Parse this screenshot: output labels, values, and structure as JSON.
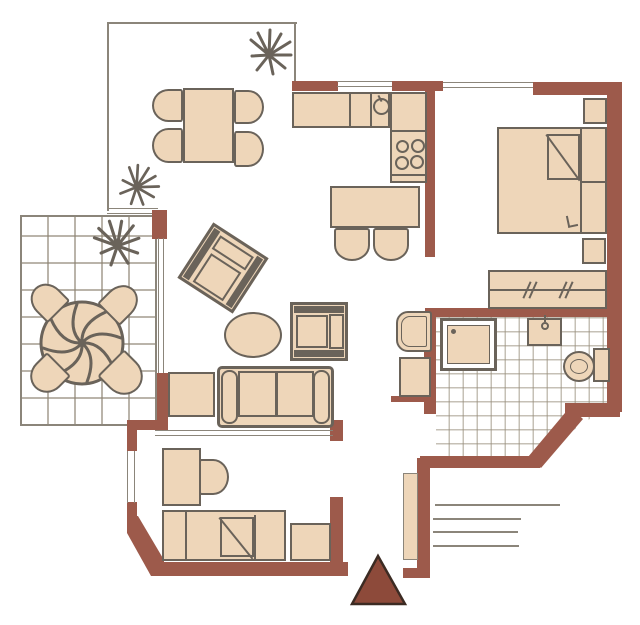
{
  "plan": {
    "type": "apartment-floor-plan",
    "title": "",
    "rooms": [
      {
        "name": "dining-terrace",
        "position": "top-left",
        "enclosure": "open (thin border)",
        "furniture": [
          "rectangular-dining-table",
          "chair x4",
          "plant x2"
        ]
      },
      {
        "name": "kitchen",
        "position": "top-middle",
        "furniture": [
          "l-shaped-counter",
          "sink",
          "stove-4-burners",
          "kitchen-table",
          "chair x2"
        ]
      },
      {
        "name": "bedroom-1",
        "position": "top-right",
        "furniture": [
          "double-bed",
          "nightstand x2",
          "wardrobe"
        ]
      },
      {
        "name": "living-room",
        "position": "center",
        "furniture": [
          "armchair-rotated",
          "armchair",
          "oval-coffee-table",
          "sofa-2-seat",
          "side-table"
        ]
      },
      {
        "name": "tiled-terrace",
        "position": "middle-left",
        "floor": "tiles",
        "furniture": [
          "round-table-with-parasol",
          "chair x4",
          "plant"
        ]
      },
      {
        "name": "bathroom",
        "position": "middle-right",
        "floor": "tiles",
        "furniture": [
          "shower",
          "washbasin",
          "toilet-with-cistern"
        ]
      },
      {
        "name": "hallway",
        "position": "center-right",
        "furniture": [
          "basin-fixture",
          "cabinet",
          "door-leaf"
        ]
      },
      {
        "name": "bedroom-2",
        "position": "bottom",
        "furniture": [
          "desk",
          "chair",
          "single-bed",
          "side-table"
        ]
      }
    ],
    "exterior": [
      "entrance-steps x4",
      "entrance-arrow-marker"
    ],
    "windows": [
      "kitchen-top x2",
      "living-room-west",
      "bedroom-2-west",
      "terrace-edge"
    ]
  },
  "colors": {
    "wall": "#9d5a4b",
    "fill": "#eed6b9",
    "outline": "#6a635a",
    "thin": "#8b857a",
    "tile": "#b9af9f",
    "marker": "#8d4a3a",
    "bg": "#ffffff"
  }
}
